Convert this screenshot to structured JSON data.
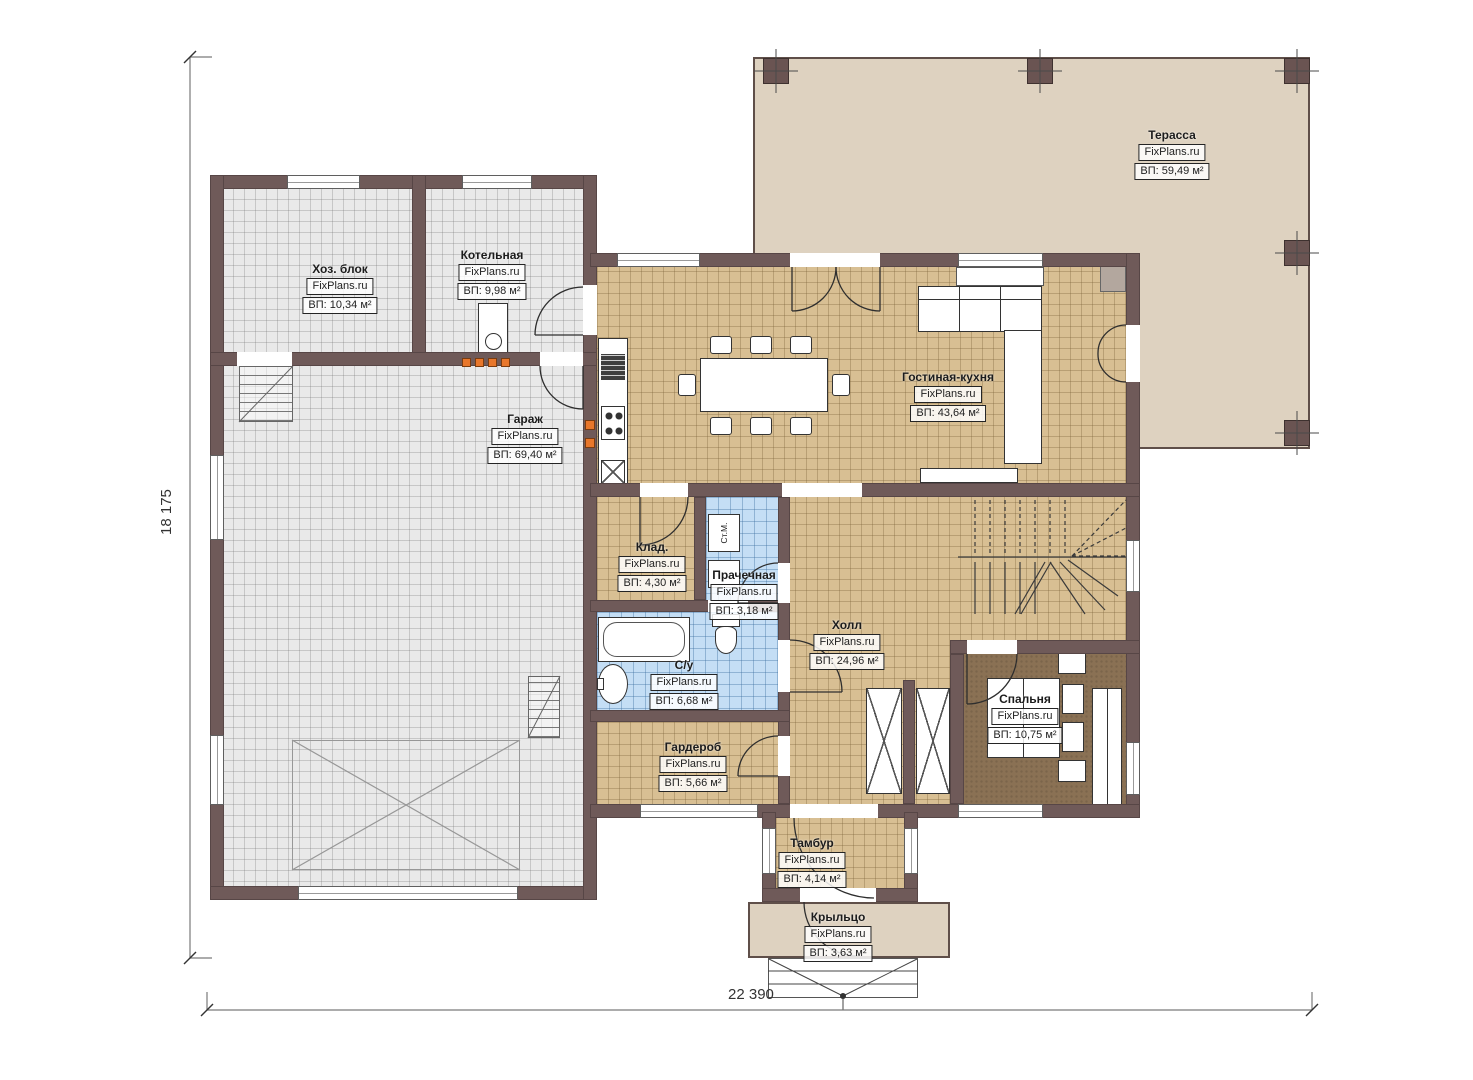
{
  "watermark": "FixPlans.ru",
  "dimensions": {
    "height_label": "18 175",
    "width_label": "22 390"
  },
  "fixtures": {
    "washer_label": "Ст.М."
  },
  "colors": {
    "wall": "#6f5a59",
    "terrace": "#ded2c0",
    "floor_tan": "#d8bf93",
    "floor_gray": "#e9e9e9",
    "floor_blue": "#c4def5",
    "floor_bedroom": "#8a7154",
    "accent_orange": "#e8772b"
  },
  "rooms": [
    {
      "id": "terrasa",
      "name": "Терасса",
      "area": "ВП: 59,49 м²"
    },
    {
      "id": "hoz-blok",
      "name": "Хоз. блок",
      "area": "ВП: 10,34 м²"
    },
    {
      "id": "kotelnaya",
      "name": "Котельная",
      "area": "ВП: 9,98 м²"
    },
    {
      "id": "garazh",
      "name": "Гараж",
      "area": "ВП: 69,40 м²"
    },
    {
      "id": "gostinaya-kuhnya",
      "name": "Гостиная-кухня",
      "area": "ВП: 43,64 м²"
    },
    {
      "id": "klad",
      "name": "Клад.",
      "area": "ВП: 4,30 м²"
    },
    {
      "id": "prachechnaya",
      "name": "Прачечная",
      "area": "ВП: 3,18 м²"
    },
    {
      "id": "holl",
      "name": "Холл",
      "area": "ВП: 24,96 м²"
    },
    {
      "id": "su",
      "name": "С/у",
      "area": "ВП: 6,68 м²"
    },
    {
      "id": "garderob",
      "name": "Гардероб",
      "area": "ВП: 5,66 м²"
    },
    {
      "id": "spalnya",
      "name": "Спальня",
      "area": "ВП: 10,75 м²"
    },
    {
      "id": "tambur",
      "name": "Тамбур",
      "area": "ВП: 4,14 м²"
    },
    {
      "id": "kryltso",
      "name": "Крыльцо",
      "area": "ВП: 3,63 м²"
    }
  ]
}
